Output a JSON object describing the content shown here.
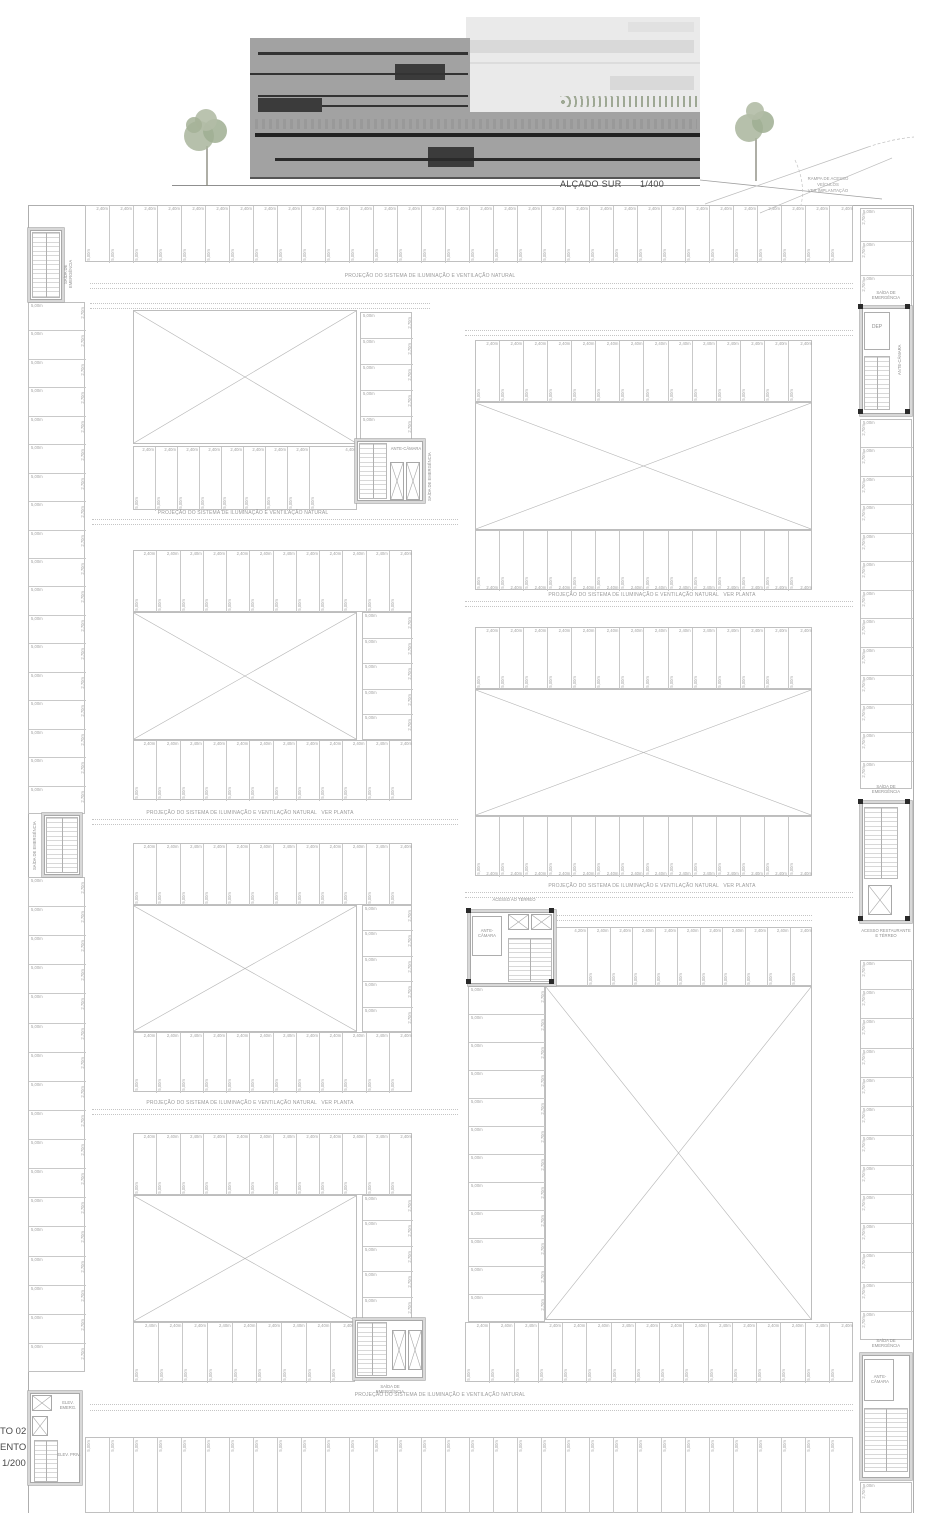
{
  "elevation": {
    "title": "ALÇADO SUR",
    "scale": "1/400",
    "ramp_note": "RAMPA DE ACESSO\nVEÍCULOS\nVER IMPLANTAÇÃO"
  },
  "plan": {
    "title_fragments": [
      "TO 02",
      "ENTO",
      "1/200"
    ],
    "notes": {
      "projection": "PROJEÇÃO DO SISTEMA DE ILUMINAÇÃO E VENTILAÇÃO NATURAL",
      "projection_ver_planta": "PROJEÇÃO DO SISTEMA DE ILUMINAÇÃO E VENTILAÇÃO NATURAL   VER PLANTA"
    },
    "labels": {
      "emergency_exit": "SAÍDA DE EMERGÊNCIA",
      "ante_chamber": "ANTE-CÂMARA",
      "dep": "DEP",
      "elev_emerg": "ELEV. EMERG.",
      "elev_priv": "ELEV. PRIV.",
      "access_ground": "ACESSO AO TÉRREO",
      "access_restaurant": "ACESSO RESTAURANTE E TÉRREO"
    },
    "dims": {
      "stall_width": "2,40m",
      "stall_depth": "5,00m",
      "side_stall_width": "5,00m",
      "side_stall_depth": "2,70m",
      "wide_stall_a": "4,40m",
      "wide_stall_b": "4,20m",
      "ante_chamber_width": "2,80m",
      "ante_chamber_depth": "1,60m"
    }
  },
  "colors": {
    "line": "#bdbdbd",
    "dim_text": "#a2a2a2",
    "note_text": "#9a9a9a",
    "facade": "#a2a2a2",
    "facade_light": "#eaeaea",
    "dark_stripe": "#333333",
    "tree": "#a9b59c"
  }
}
